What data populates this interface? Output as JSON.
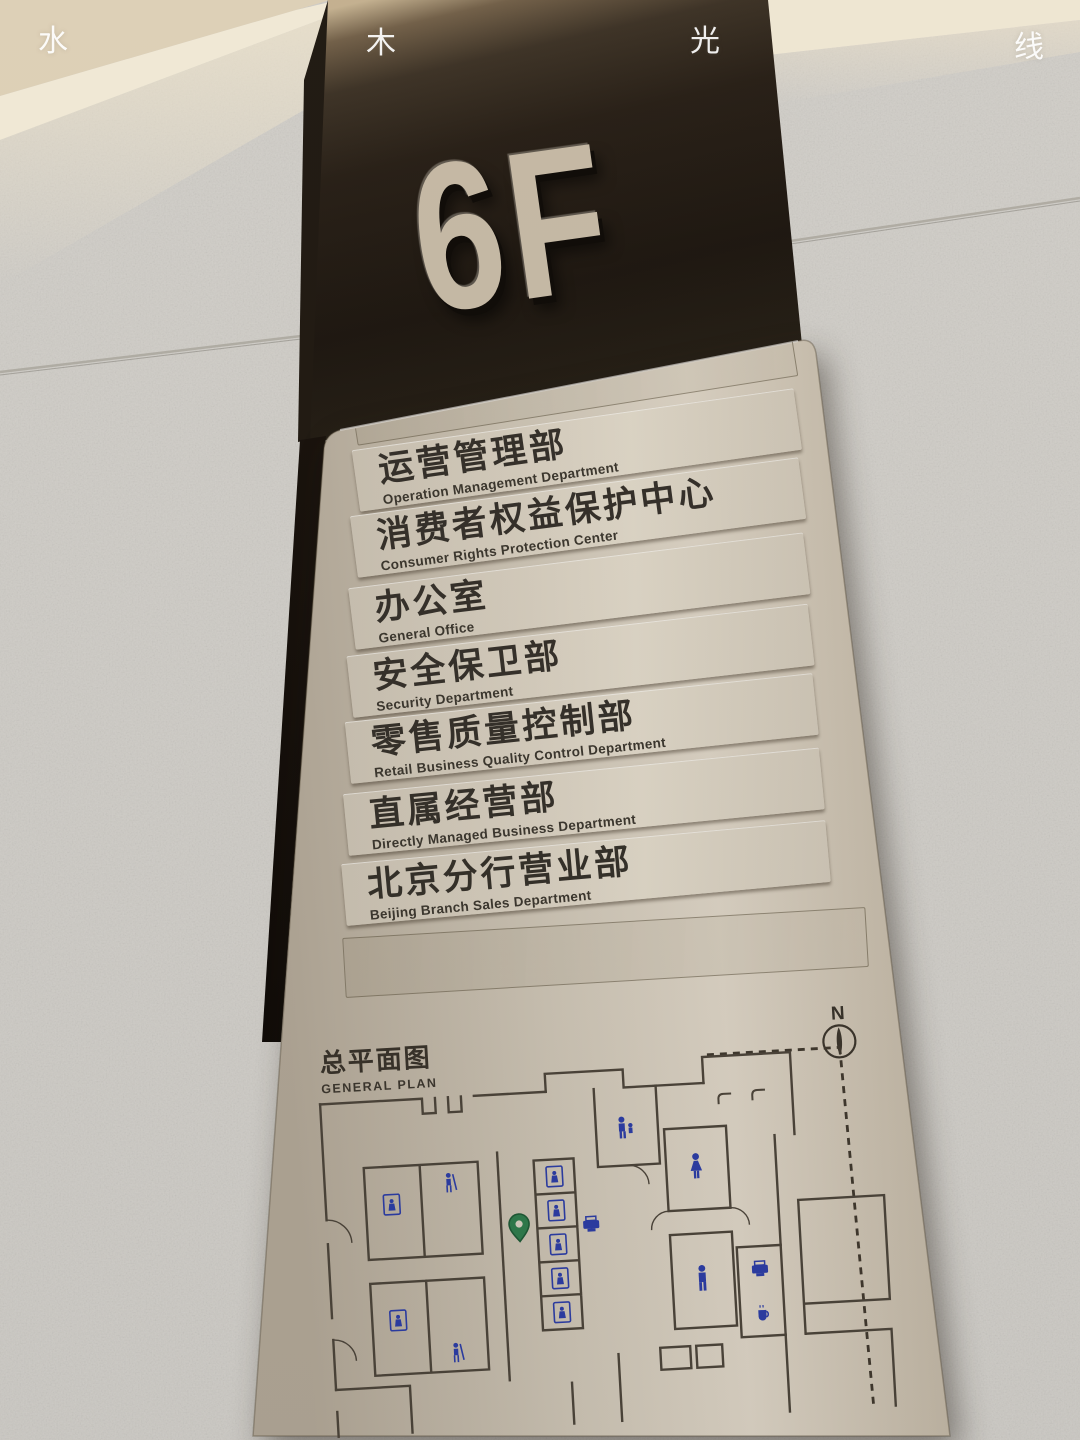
{
  "watermark": {
    "chars": [
      "水",
      "木",
      "光",
      "线"
    ]
  },
  "floor_badge": {
    "label": "6F"
  },
  "directory": {
    "rows": [
      {
        "zh": "运营管理部",
        "en": "Operation Management Department"
      },
      {
        "zh": "消费者权益保护中心",
        "en": "Consumer Rights Protection Center"
      },
      {
        "zh": "办公室",
        "en": "General Office"
      },
      {
        "zh": "安全保卫部",
        "en": "Security Department"
      },
      {
        "zh": "零售质量控制部",
        "en": "Retail Business Quality Control Department"
      },
      {
        "zh": "直属经营部",
        "en": "Directly Managed Business Department"
      },
      {
        "zh": "北京分行营业部",
        "en": "Beijing Branch Sales Department"
      }
    ]
  },
  "plan": {
    "title_zh": "总平面图",
    "title_en": "GENERAL PLAN",
    "north_label": "N",
    "icons": [
      "elevator-icon",
      "service-person-icon",
      "family-restroom-icon",
      "restroom-female-icon",
      "restroom-male-icon",
      "printer-icon",
      "coffee-point-icon",
      "coat-hook-icon",
      "location-pin-icon",
      "north-compass-icon"
    ]
  },
  "colors": {
    "pillar_dark": "#241d15",
    "panel_metal": "#d2cabb",
    "text_dark": "#34302a",
    "plan_wall": "#4b443a",
    "facility_blue": "#2b3da8",
    "location_green": "#2e7d4e",
    "granite": "#d7d5d0",
    "ceiling_warm": "#f3ead4"
  }
}
